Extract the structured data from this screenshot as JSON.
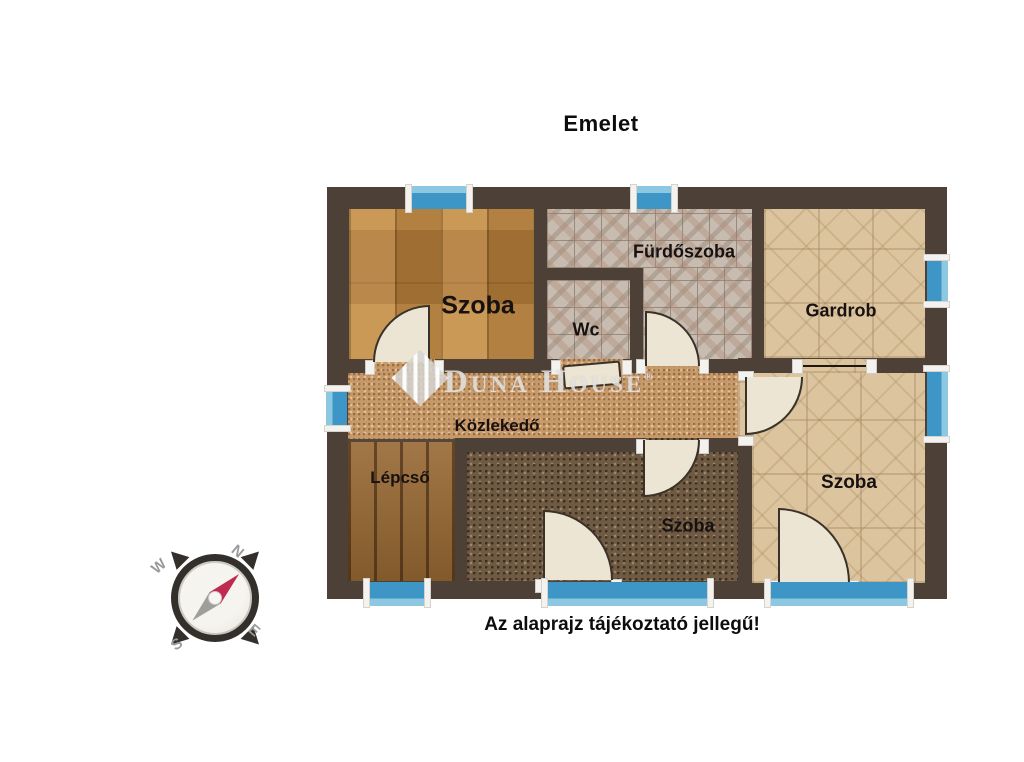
{
  "title": "Emelet",
  "disclaimer": "Az alaprajz tájékoztató jellegű!",
  "watermark": {
    "name": "Duna House",
    "registered_mark": "®"
  },
  "compass": {
    "north": "N",
    "west": "W",
    "south": "S",
    "east": "E"
  },
  "rooms": {
    "szoba_top_left": "Szoba",
    "furdoszoba": "Fürdőszoba",
    "wc": "Wc",
    "gardrob": "Gardrob",
    "kozlekedo": "Közlekedő",
    "lepcso": "Lépcső",
    "szoba_bottom": "Szoba",
    "szoba_right": "Szoba"
  },
  "colors": {
    "wall": "#4d4037",
    "window_pane": "#3e96c6",
    "window_pane_light": "#8cc8e2",
    "door_leaf": "#ece5d4",
    "compass_needle_north": "#c02a50",
    "compass_needle_south": "#9e9e9b"
  }
}
